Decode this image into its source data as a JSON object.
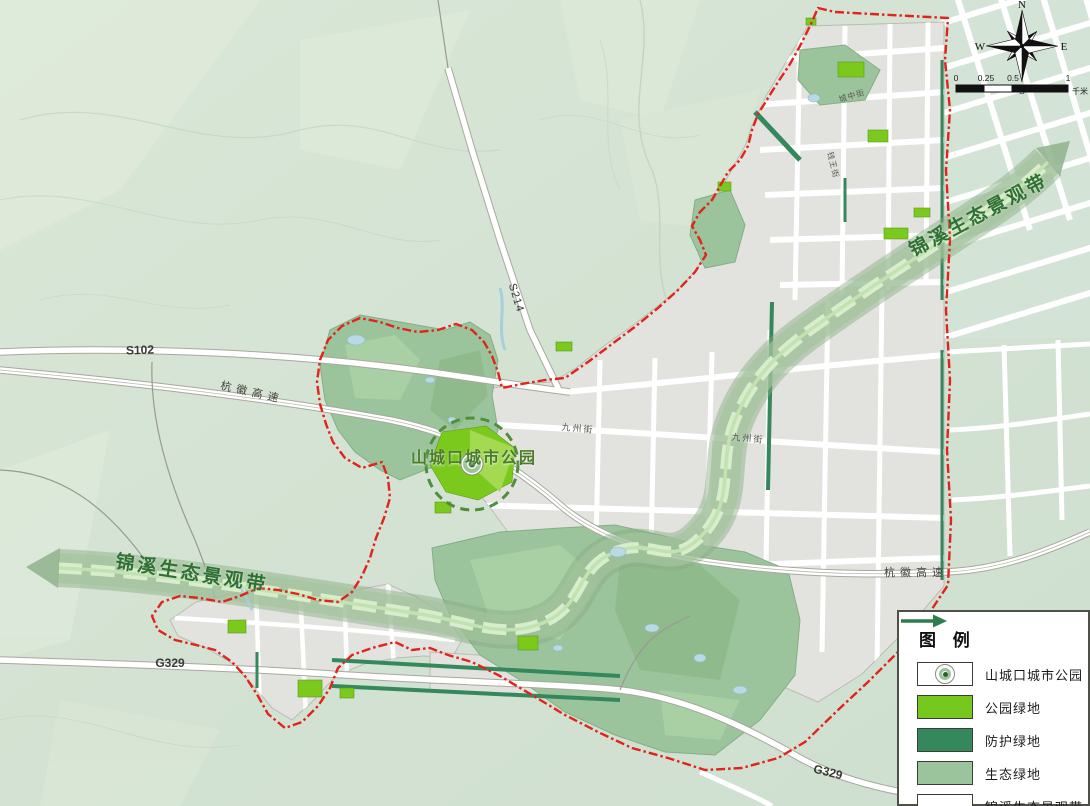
{
  "map": {
    "labels": {
      "park": "山城口城市公园",
      "band_ne": "锦溪生态景观带",
      "band_sw": "锦溪生态景观带",
      "s102": "S102",
      "s214": "S214",
      "g329_w": "G329",
      "g329_e": "G329",
      "hanghui_w": "杭徽高速",
      "hanghui_e": "杭徽高速",
      "jiuzhou_w": "九州街",
      "jiuzhou_e": "九州街",
      "chengzhong": "城中街",
      "qianwang": "钱王街"
    },
    "compass": {
      "n": "N",
      "e": "E",
      "s": "S",
      "w": "W"
    },
    "scalebar": {
      "t0": "0",
      "t1": "0.25",
      "t2": "0.5",
      "t3": "1",
      "unit": "千米"
    }
  },
  "legend": {
    "title": "图 例",
    "items": [
      {
        "label": "山城口城市公园",
        "symbol": "park-circle-symbol"
      },
      {
        "label": "公园绿地",
        "symbol": "swatch",
        "color": "#76c81e"
      },
      {
        "label": "防护绿地",
        "symbol": "swatch",
        "color": "#35885c"
      },
      {
        "label": "生态绿地",
        "symbol": "swatch",
        "color": "#9bc49d"
      },
      {
        "label": "锦溪生态景观带",
        "symbol": "green-arrow"
      }
    ]
  },
  "colors": {
    "background": "#d5e3d4",
    "urban_gray": "#e2e2df",
    "ecological_green": "#9bc49d",
    "park_green": "#76c81e",
    "protective_green": "#35885c",
    "band_green": "#9fc29b",
    "boundary_red": "#e2231a",
    "water_blue": "#b9dae4",
    "label_green": "#2f7135"
  }
}
